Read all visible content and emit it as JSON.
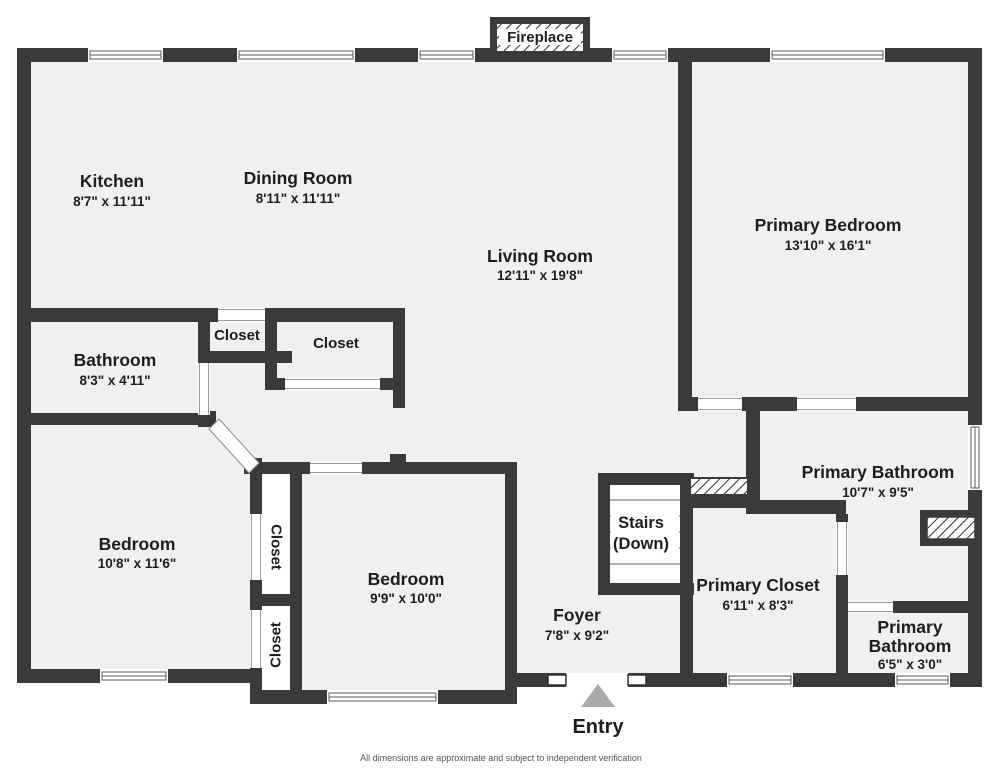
{
  "plan": {
    "fireplace_label": "Fireplace",
    "entry_label": "Entry",
    "stairs": {
      "line1": "Stairs",
      "line2": "(Down)"
    },
    "footer": "All dimensions are approximate and subject to independent verification",
    "rooms": {
      "kitchen": {
        "name": "Kitchen",
        "dims": "8'7\" x 11'11\""
      },
      "dining_room": {
        "name": "Dining Room",
        "dims": "8'11\" x 11'11\""
      },
      "living_room": {
        "name": "Living Room",
        "dims": "12'11\" x 19'8\""
      },
      "primary_bedroom": {
        "name": "Primary Bedroom",
        "dims": "13'10\" x 16'1\""
      },
      "bathroom": {
        "name": "Bathroom",
        "dims": "8'3\" x 4'11\""
      },
      "closet_hall_small": {
        "name": "Closet"
      },
      "closet_hall_large": {
        "name": "Closet"
      },
      "bedroom_left": {
        "name": "Bedroom",
        "dims": "10'8\" x 11'6\""
      },
      "bedroom_middle": {
        "name": "Bedroom",
        "dims": "9'9\" x 10'0\""
      },
      "closet_vertical_upper": {
        "name": "Closet"
      },
      "closet_vertical_lower": {
        "name": "Closet"
      },
      "foyer": {
        "name": "Foyer",
        "dims": "7'8\" x 9'2\""
      },
      "primary_closet": {
        "name": "Primary Closet",
        "dims": "6'11\" x 8'3\""
      },
      "primary_bathroom": {
        "name": "Primary Bathroom",
        "dims": "10'7\" x 9'5\""
      },
      "primary_bathroom_small": {
        "name_line1": "Primary",
        "name_line2": "Bathroom",
        "dims": "6'5\" x 3'0\""
      }
    },
    "colors": {
      "wall": "#3a3a3a",
      "floor": "#f0f0f0",
      "entry_arrow": "#a9a9a9",
      "text": "#1d1d1d",
      "footer_text": "#555555"
    }
  }
}
